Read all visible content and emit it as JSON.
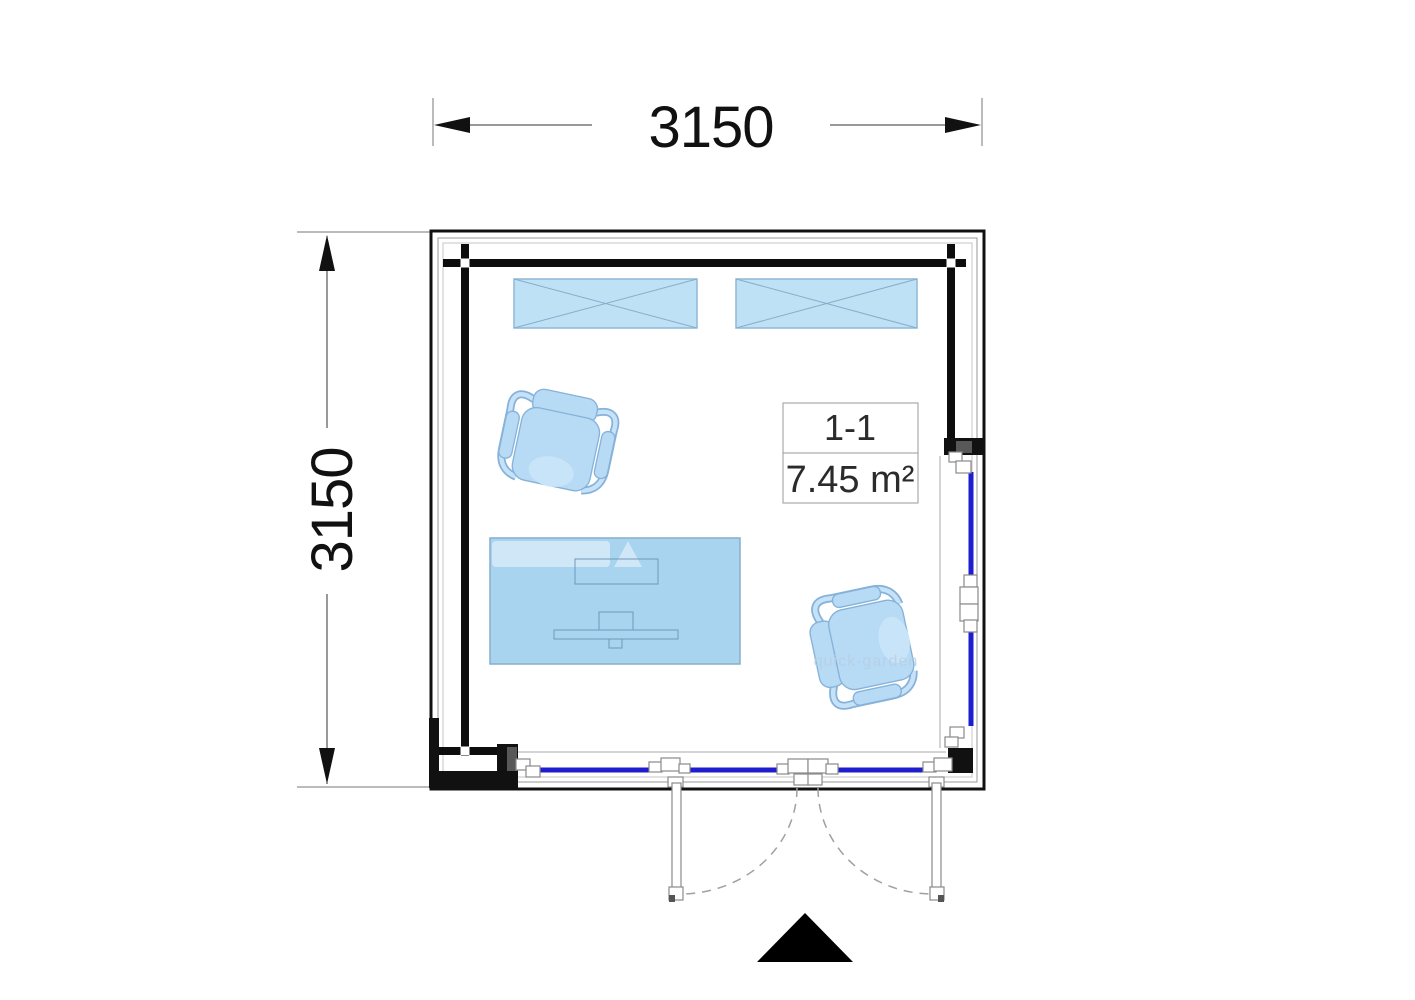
{
  "drawing": {
    "type": "floor-plan",
    "dimensions": {
      "top": "3150",
      "left": "3150"
    },
    "room_label": {
      "name": "1-1",
      "area": "7.45 m²"
    },
    "watermark": "quick-garden",
    "colors": {
      "glazing_blue": "#1e1ecf",
      "wall_black": "#0d0d0d",
      "skylight_fill": "#bfe1f5",
      "desk_fill": "#a9d4f0",
      "chair_fill": "#b7daf5",
      "furniture_stroke": "#86aecb"
    },
    "icons": {
      "entrance_marker": "filled-triangle-up",
      "dimension_arrows": "filled-arrowheads"
    },
    "features": {
      "skylight_count": 2,
      "chair_count": 2,
      "door_leaves": 2
    }
  }
}
